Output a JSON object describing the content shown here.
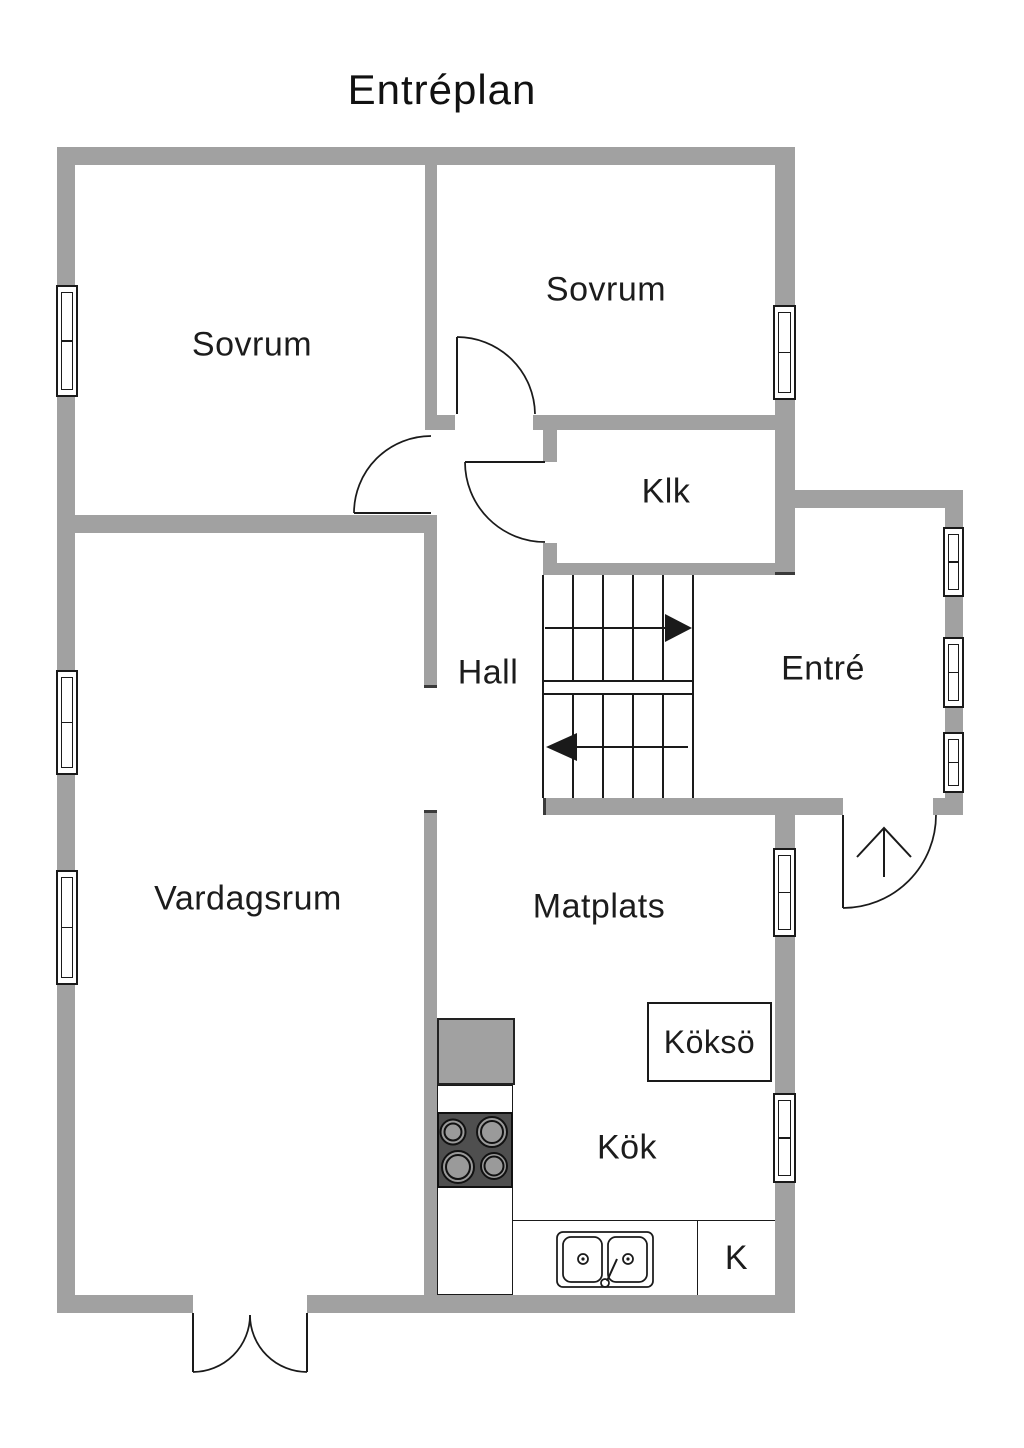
{
  "title": "Entréplan",
  "rooms": {
    "sovrum_left": "Sovrum",
    "sovrum_right": "Sovrum",
    "klk": "Klk",
    "hall": "Hall",
    "entre": "Entré",
    "vardagsrum": "Vardagsrum",
    "matplats": "Matplats",
    "kokso": "Köksö",
    "kok": "Kök",
    "kyl": "K"
  },
  "colors": {
    "wall": "#a1a1a1",
    "line": "#1a1a1a",
    "stove": "#4f4f4f",
    "burner": "#9a9a9a",
    "bg": "#ffffff"
  }
}
